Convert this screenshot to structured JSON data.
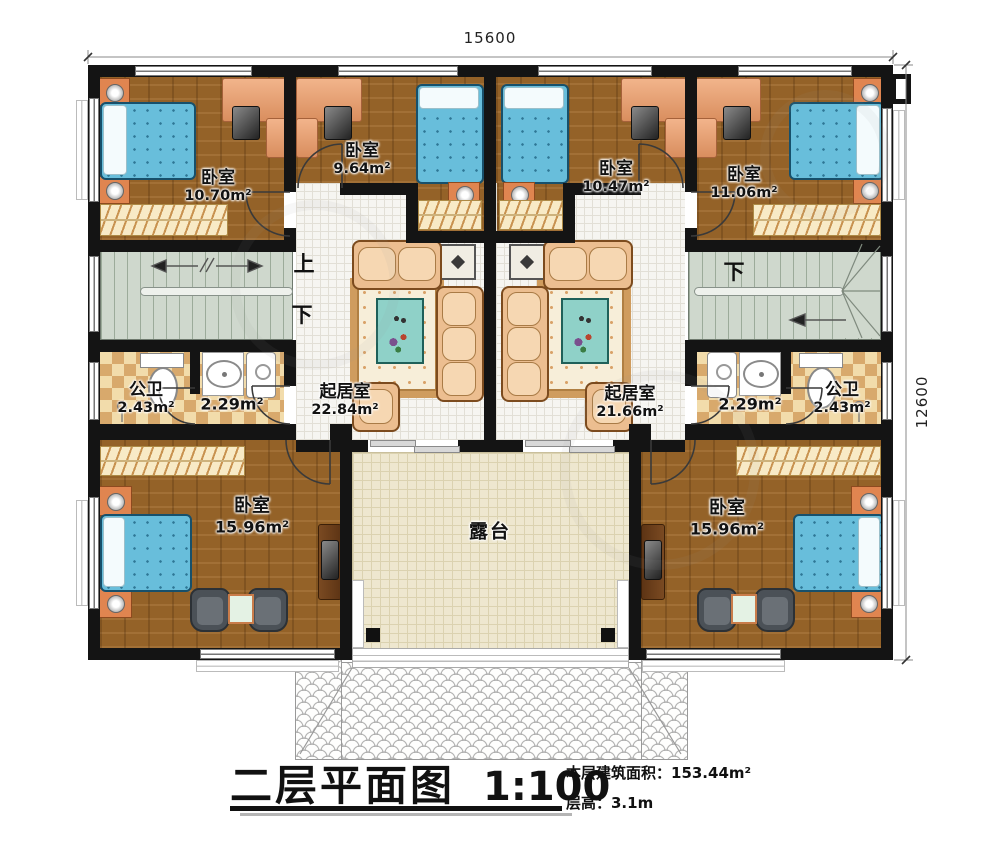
{
  "plan": {
    "dims": {
      "width": "15600",
      "height": "12600"
    },
    "stair": {
      "up": "上",
      "down": "下"
    },
    "rooms": {
      "bedroom_tl": {
        "name": "卧室",
        "area": "10.70m²"
      },
      "bedroom_tml": {
        "name": "卧室",
        "area": "9.64m²"
      },
      "bedroom_tmr": {
        "name": "卧室",
        "area": "10.47m²"
      },
      "bedroom_tr": {
        "name": "卧室",
        "area": "11.06m²"
      },
      "bath_l": {
        "name": "公卫",
        "area": "2.43m²"
      },
      "wash_l": {
        "area": "2.29m²"
      },
      "living_l": {
        "name": "起居室",
        "area": "22.84m²"
      },
      "living_r": {
        "name": "起居室",
        "area": "21.66m²"
      },
      "wash_r": {
        "area": "2.29m²"
      },
      "bath_r": {
        "name": "公卫",
        "area": "2.43m²"
      },
      "bedroom_bl": {
        "name": "卧室",
        "area": "15.96m²"
      },
      "bedroom_br": {
        "name": "卧室",
        "area": "15.96m²"
      },
      "terrace": {
        "name": "露台"
      }
    },
    "colors": {
      "wall": "#141414",
      "wood_floor": "#9c672a",
      "bed": "#68bedb",
      "terrace_tile": "#eee7cf",
      "bath_tile": "#d8a96c",
      "stair": "#cfd8cd"
    }
  },
  "titleblock": {
    "title": "二层平面图",
    "scale": "1:100",
    "info_area": "本层建筑面积：153.44m²",
    "info_height": "层高：3.1m"
  }
}
